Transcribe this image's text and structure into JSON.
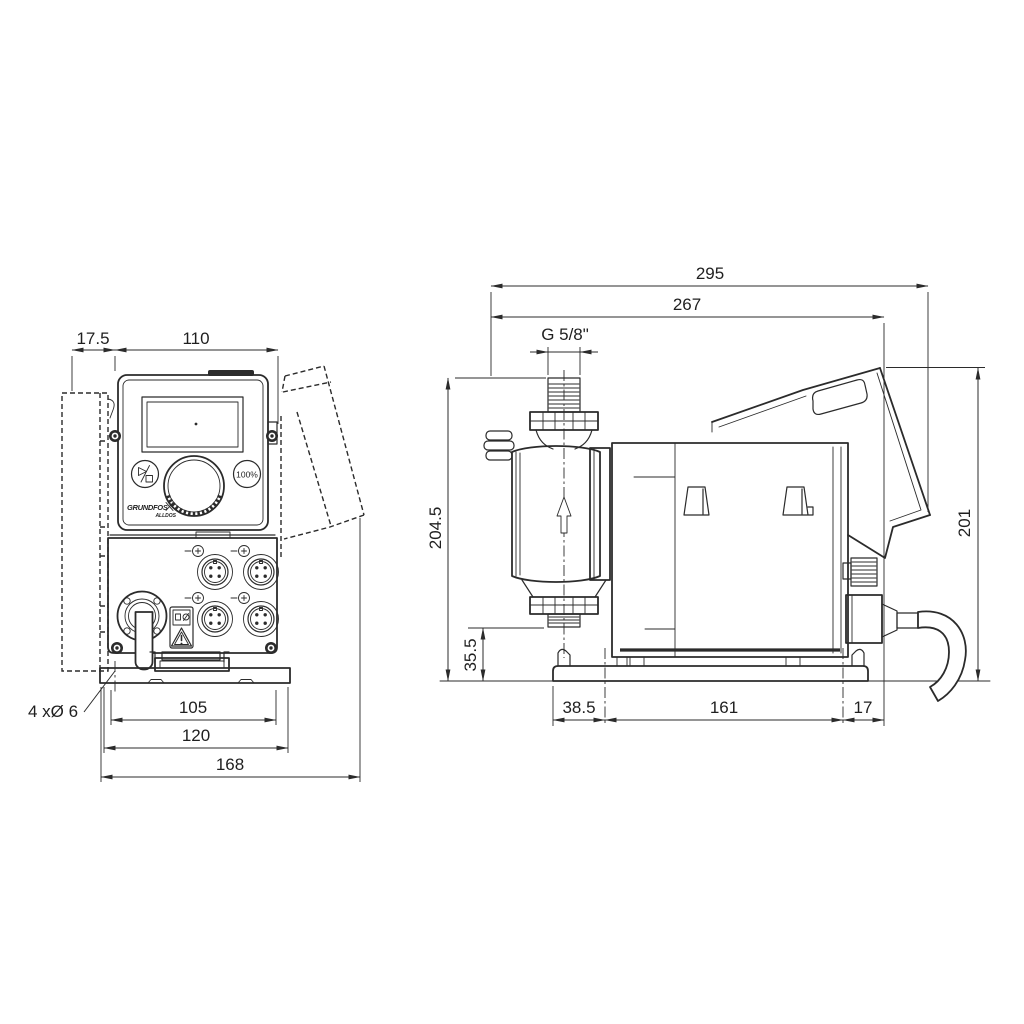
{
  "colors": {
    "ink": "#2b2b2b",
    "background": "#ffffff"
  },
  "front_view": {
    "dim_mount_offset": "17.5",
    "dim_width": "110",
    "hole_note": "4 xØ 6",
    "dim_hole_span": "105",
    "dim_plate_width": "120",
    "dim_overall_width": "168",
    "button_right_label": "100%",
    "logo": "GRUNDFOS",
    "logo_sub": "ALLDOS"
  },
  "side_view": {
    "dim_overall_depth": "295",
    "dim_depth_to_cover": "267",
    "thread_label": "G 5/8\"",
    "dim_overall_height": "204.5",
    "dim_port_height": "35.5",
    "dim_cover_height": "201",
    "dim_base_to_center": "38.5",
    "dim_mount_holes": "161",
    "dim_rear_offset": "17"
  },
  "icons": {
    "start_stop": "play-stop-icon",
    "warning": "warning-triangle-icon",
    "flow": "flow-direction-arrow-icon"
  }
}
